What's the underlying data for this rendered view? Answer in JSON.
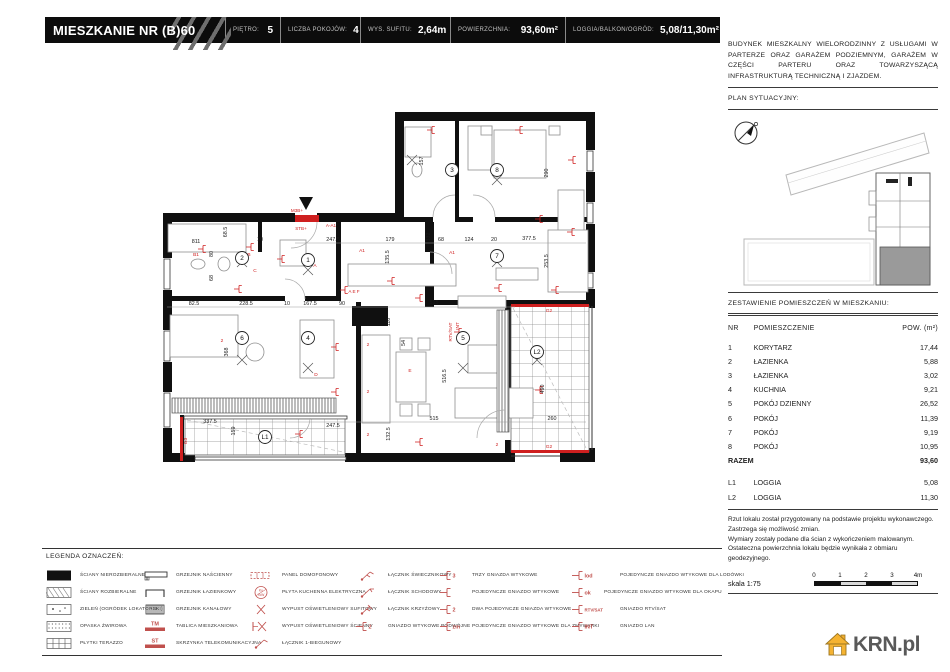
{
  "header": {
    "title": "MIESZKANIE NR (B)60",
    "specs": [
      {
        "label": "PIĘTRO:",
        "value": "5"
      },
      {
        "label": "LICZBA POKOJÓW:",
        "value": "4"
      },
      {
        "label": "WYS. SUFITU:",
        "value": "2,64m"
      },
      {
        "label": "POWIERZCHNIA:",
        "value": "93,60m²"
      },
      {
        "label": "LOGGIA/BALKON/OGRÓD:",
        "value": "5,08/11,30m²"
      }
    ]
  },
  "sidebar": {
    "description": "BUDYNEK MIESZKALNY WIELORODZINNY Z USŁUGAMI W PARTERZE ORAZ GARAŻEM PODZIEMNYM, GARAŻEM W CZĘŚCI PARTERU ORAZ TOWARZYSZĄCĄ INFRASTRUKTURĄ TECHNICZNĄ I ZJAZDEM.",
    "site_plan_label": "PLAN SYTUACYJNY:",
    "rooms_title": "ZESTAWIENIE POMIESZCZEŃ W MIESZKANIU:",
    "table": {
      "headers": [
        "NR",
        "POMIESZCZENIE",
        "POW. (m²)"
      ],
      "rows": [
        [
          "1",
          "KORYTARZ",
          "17,44"
        ],
        [
          "2",
          "ŁAZIENKA",
          "5,88"
        ],
        [
          "3",
          "ŁAZIENKA",
          "3,02"
        ],
        [
          "4",
          "KUCHNIA",
          "9,21"
        ],
        [
          "5",
          "POKÓJ DZIENNY",
          "26,52"
        ],
        [
          "6",
          "POKÓJ",
          "11,39"
        ],
        [
          "7",
          "POKÓJ",
          "9,19"
        ],
        [
          "8",
          "POKÓJ",
          "10,95"
        ]
      ],
      "total": {
        "label": "RAZEM",
        "value": "93,60"
      },
      "loggias": [
        [
          "L1",
          "LOGGIA",
          "5,08"
        ],
        [
          "L2",
          "LOGGIA",
          "11,30"
        ]
      ]
    },
    "disclaimer": [
      "Rzut lokalu został przygotowany na podstawie projektu wykonawczego.",
      "Zastrzega się możliwość zmian.",
      "Wymiary zostały podane dla ścian z wykończeniem malowanym.",
      "Ostateczna powierzchnia lokalu będzie wynikała z obmiaru geodezyjnego."
    ],
    "scale_label": "skala 1:75",
    "scale_ticks": [
      "0",
      "1",
      "2",
      "3",
      "4m"
    ]
  },
  "legend": {
    "title": "LEGENDA OZNACZEŃ:",
    "columns": [
      [
        {
          "icon": "wall-solid",
          "label": "ŚCIANY NIEROZBIERALNE"
        },
        {
          "icon": "wall-hatched",
          "label": "ŚCIANY ROZBIERALNE"
        },
        {
          "icon": "greenery",
          "label": "ZIELEŃ (OGRÓDEK LOKATORSKI)"
        },
        {
          "icon": "gravel",
          "label": "OPASKA ŻWIROWA"
        },
        {
          "icon": "terrazzo",
          "label": "PŁYTKI TERAZZO"
        }
      ],
      [
        {
          "icon": "radiator-wall",
          "label": "GRZEJNIK NAŚCIENNY"
        },
        {
          "icon": "radiator-bath",
          "label": "GRZEJNIK ŁAZIENKOWY"
        },
        {
          "icon": "radiator-duct",
          "label": "GRZEJNIK KANAŁOWY"
        },
        {
          "icon": "tm",
          "tag": "TM",
          "label": "TABLICA MIESZKANIOWA"
        },
        {
          "icon": "st",
          "tag": "ST",
          "label": "SKRZYNKA TELEKOMUNIKACYJNA"
        }
      ],
      [
        {
          "icon": "intercom",
          "label": "PANEL DOMOFONOWY"
        },
        {
          "icon": "cooktop",
          "tag": "Ku 7kW",
          "label": "PŁYTA KUCHENNA ELEKTRYCZNA"
        },
        {
          "icon": "light-ceiling",
          "label": "WYPUST OŚWIETLENIOWY SUFITOWY"
        },
        {
          "icon": "light-wall",
          "label": "WYPUST OŚWIETLENIOWY ŚCIENNY"
        },
        {
          "icon": "switch-1",
          "label": "ŁĄCZNIK 1-BIEGUNOWY"
        }
      ],
      [
        {
          "icon": "switch-chandelier",
          "label": "ŁĄCZNIK ŚWIECZNIKOWY"
        },
        {
          "icon": "switch-stair",
          "label": "ŁĄCZNIK SCHODOWY"
        },
        {
          "icon": "switch-cross",
          "label": "ŁĄCZNIK KRZYŻOWY"
        },
        {
          "icon": "socket",
          "tag": "2",
          "label": "GNIAZDO WTYKOWE PODWÓJNE"
        }
      ],
      [
        {
          "icon": "socket",
          "tag": "3",
          "label": "TRZY GNIAZDA WTYKOWE"
        },
        {
          "icon": "socket",
          "tag": "",
          "label": "POJEDYNCZE GNIAZDO WTYKOWE"
        },
        {
          "icon": "socket",
          "tag": "2",
          "label": "DWA POJEDYNCZE GNIAZDA WTYKOWE"
        },
        {
          "icon": "socket",
          "tag": "zm",
          "label": "POJEDYNCZE GNIAZDO WTYKOWE DLA ZMYWARKI"
        }
      ],
      [
        {
          "icon": "socket",
          "tag": "lod",
          "label": "POJEDYNCZE GNIAZDO WTYKOWE DLA LODÓWKI"
        },
        {
          "icon": "socket",
          "tag": "ok",
          "label": "POJEDYNCZE GNIAZDO WTYKOWE DLA OKAPU"
        },
        {
          "icon": "socket",
          "tag": "RTV/SAT",
          "label": "GNIAZDO RTV/SAT"
        },
        {
          "icon": "socket",
          "tag": "INT",
          "label": "GNIAZDO LAN"
        }
      ]
    ]
  },
  "plan": {
    "rooms": [
      {
        "id": "1",
        "x": 308,
        "y": 260
      },
      {
        "id": "2",
        "x": 242,
        "y": 258
      },
      {
        "id": "3",
        "x": 452,
        "y": 170
      },
      {
        "id": "4",
        "x": 308,
        "y": 338
      },
      {
        "id": "5",
        "x": 463,
        "y": 338
      },
      {
        "id": "6",
        "x": 242,
        "y": 338
      },
      {
        "id": "7",
        "x": 497,
        "y": 256
      },
      {
        "id": "8",
        "x": 497,
        "y": 170
      },
      {
        "id": "L1",
        "x": 265,
        "y": 437
      },
      {
        "id": "L2",
        "x": 537,
        "y": 352
      }
    ],
    "dims": [
      {
        "t": "247.5",
        "x": 333,
        "y": 241
      },
      {
        "t": "179",
        "x": 390,
        "y": 241
      },
      {
        "t": "68",
        "x": 441,
        "y": 241
      },
      {
        "t": "124",
        "x": 469,
        "y": 241
      },
      {
        "t": "20",
        "x": 494,
        "y": 241
      },
      {
        "t": "377.5",
        "x": 529,
        "y": 240
      },
      {
        "t": "10",
        "x": 260,
        "y": 241
      },
      {
        "t": "811",
        "x": 196,
        "y": 243
      },
      {
        "t": "68.5",
        "x": 227,
        "y": 232,
        "r": 1
      },
      {
        "t": "80",
        "x": 213,
        "y": 254,
        "r": 1
      },
      {
        "t": "68",
        "x": 213,
        "y": 278,
        "r": 1
      },
      {
        "t": "332",
        "x": 430,
        "y": 237,
        "r": 1
      },
      {
        "t": "135.5",
        "x": 389,
        "y": 257,
        "r": 1
      },
      {
        "t": "157",
        "x": 423,
        "y": 161,
        "r": 1
      },
      {
        "t": "290",
        "x": 548,
        "y": 173,
        "r": 1
      },
      {
        "t": "253.5",
        "x": 548,
        "y": 261,
        "r": 1
      },
      {
        "t": "82.5",
        "x": 194,
        "y": 305
      },
      {
        "t": "228.5",
        "x": 246,
        "y": 305
      },
      {
        "t": "10",
        "x": 287,
        "y": 305
      },
      {
        "t": "167.5",
        "x": 310,
        "y": 305
      },
      {
        "t": "90",
        "x": 342,
        "y": 305
      },
      {
        "t": "515",
        "x": 434,
        "y": 304
      },
      {
        "t": "118",
        "x": 390,
        "y": 322,
        "r": 1
      },
      {
        "t": "54",
        "x": 405,
        "y": 343,
        "r": 1
      },
      {
        "t": "368",
        "x": 228,
        "y": 352,
        "r": 1
      },
      {
        "t": "516.5",
        "x": 446,
        "y": 376,
        "r": 1
      },
      {
        "t": "490",
        "x": 544,
        "y": 389,
        "r": 1
      },
      {
        "t": "337.5",
        "x": 210,
        "y": 423
      },
      {
        "t": "159",
        "x": 235,
        "y": 431,
        "r": 1
      },
      {
        "t": "247.5",
        "x": 333,
        "y": 427
      },
      {
        "t": "132.5",
        "x": 390,
        "y": 434,
        "r": 1
      },
      {
        "t": "515",
        "x": 434,
        "y": 420
      },
      {
        "t": "260",
        "x": 552,
        "y": 420
      }
    ],
    "red_labels": [
      {
        "t": "M3B+",
        "x": 297,
        "y": 212
      },
      {
        "t": "STB+",
        "x": 301,
        "y": 230
      },
      {
        "t": "A-A1",
        "x": 331,
        "y": 227
      },
      {
        "t": "RTV/SAT",
        "x": 452,
        "y": 332,
        "r": 1
      },
      {
        "t": "INT",
        "x": 459,
        "y": 326,
        "r": 1
      },
      {
        "t": "G2",
        "x": 549,
        "y": 312
      },
      {
        "t": "G2",
        "x": 549,
        "y": 448
      },
      {
        "t": "G3",
        "x": 187,
        "y": 441,
        "r": 1
      },
      {
        "t": "A",
        "x": 315,
        "y": 267
      },
      {
        "t": "A1",
        "x": 362,
        "y": 252
      },
      {
        "t": "B1",
        "x": 196,
        "y": 256
      },
      {
        "t": "B",
        "x": 249,
        "y": 256
      },
      {
        "t": "C",
        "x": 255,
        "y": 272
      },
      {
        "t": "A E F",
        "x": 354,
        "y": 293
      },
      {
        "t": "D",
        "x": 316,
        "y": 376
      },
      {
        "t": "E",
        "x": 410,
        "y": 372
      },
      {
        "t": "A1",
        "x": 452,
        "y": 254
      },
      {
        "t": "2",
        "x": 368,
        "y": 346
      },
      {
        "t": "2",
        "x": 368,
        "y": 393
      },
      {
        "t": "2",
        "x": 368,
        "y": 436
      },
      {
        "t": "2",
        "x": 222,
        "y": 342
      },
      {
        "t": "2",
        "x": 541,
        "y": 392
      },
      {
        "t": "2",
        "x": 497,
        "y": 446
      }
    ],
    "sockets": [
      [
        251,
        247
      ],
      [
        282,
        259
      ],
      [
        239,
        289
      ],
      [
        203,
        249
      ],
      [
        345,
        290
      ],
      [
        392,
        281
      ],
      [
        420,
        298
      ],
      [
        336,
        347
      ],
      [
        336,
        392
      ],
      [
        300,
        434
      ],
      [
        540,
        219
      ],
      [
        572,
        232
      ],
      [
        499,
        288
      ],
      [
        556,
        290
      ],
      [
        459,
        332
      ],
      [
        540,
        390
      ],
      [
        420,
        442
      ],
      [
        573,
        160
      ],
      [
        520,
        130
      ],
      [
        432,
        130
      ]
    ],
    "lights": [
      [
        308,
        270
      ],
      [
        242,
        262
      ],
      [
        242,
        360
      ],
      [
        308,
        368
      ],
      [
        463,
        368
      ],
      [
        497,
        180
      ],
      [
        497,
        262
      ],
      [
        537,
        360
      ],
      [
        412,
        160
      ]
    ]
  },
  "logo": {
    "text": "KRN.pl"
  }
}
